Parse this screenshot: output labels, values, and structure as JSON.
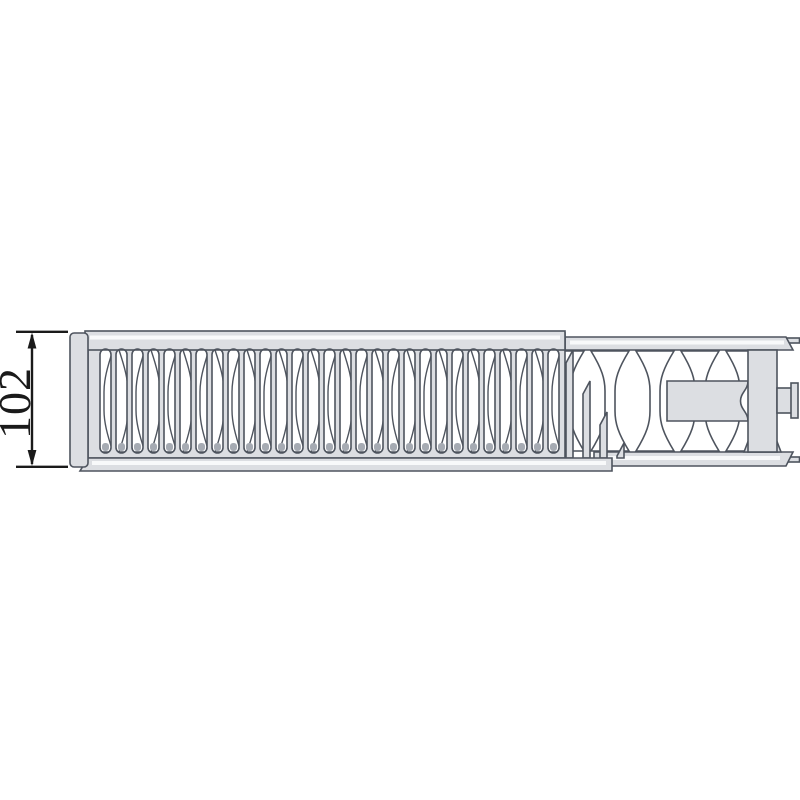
{
  "page": {
    "background": "#ffffff"
  },
  "dimension": {
    "label": "102"
  },
  "diagram": {
    "slot_count": 29,
    "slot_start_x": 100,
    "slot_pitch": 16,
    "slot_width": 11,
    "grille_fin_count": 15,
    "grille_fin_pitch": 32,
    "exposed_fin_count": 5,
    "exposed_fin_start_x": 565,
    "exposed_fin_pitch": 45,
    "cutaway_step_count": 4,
    "colors": {
      "background": "#ffffff",
      "fill": "#dcdee2",
      "outline": "#4e545e",
      "highlight": "#f8f9fa",
      "slot": "#ffffff",
      "shading": "#a6abb3",
      "dimension": "#1a1a1a"
    }
  }
}
